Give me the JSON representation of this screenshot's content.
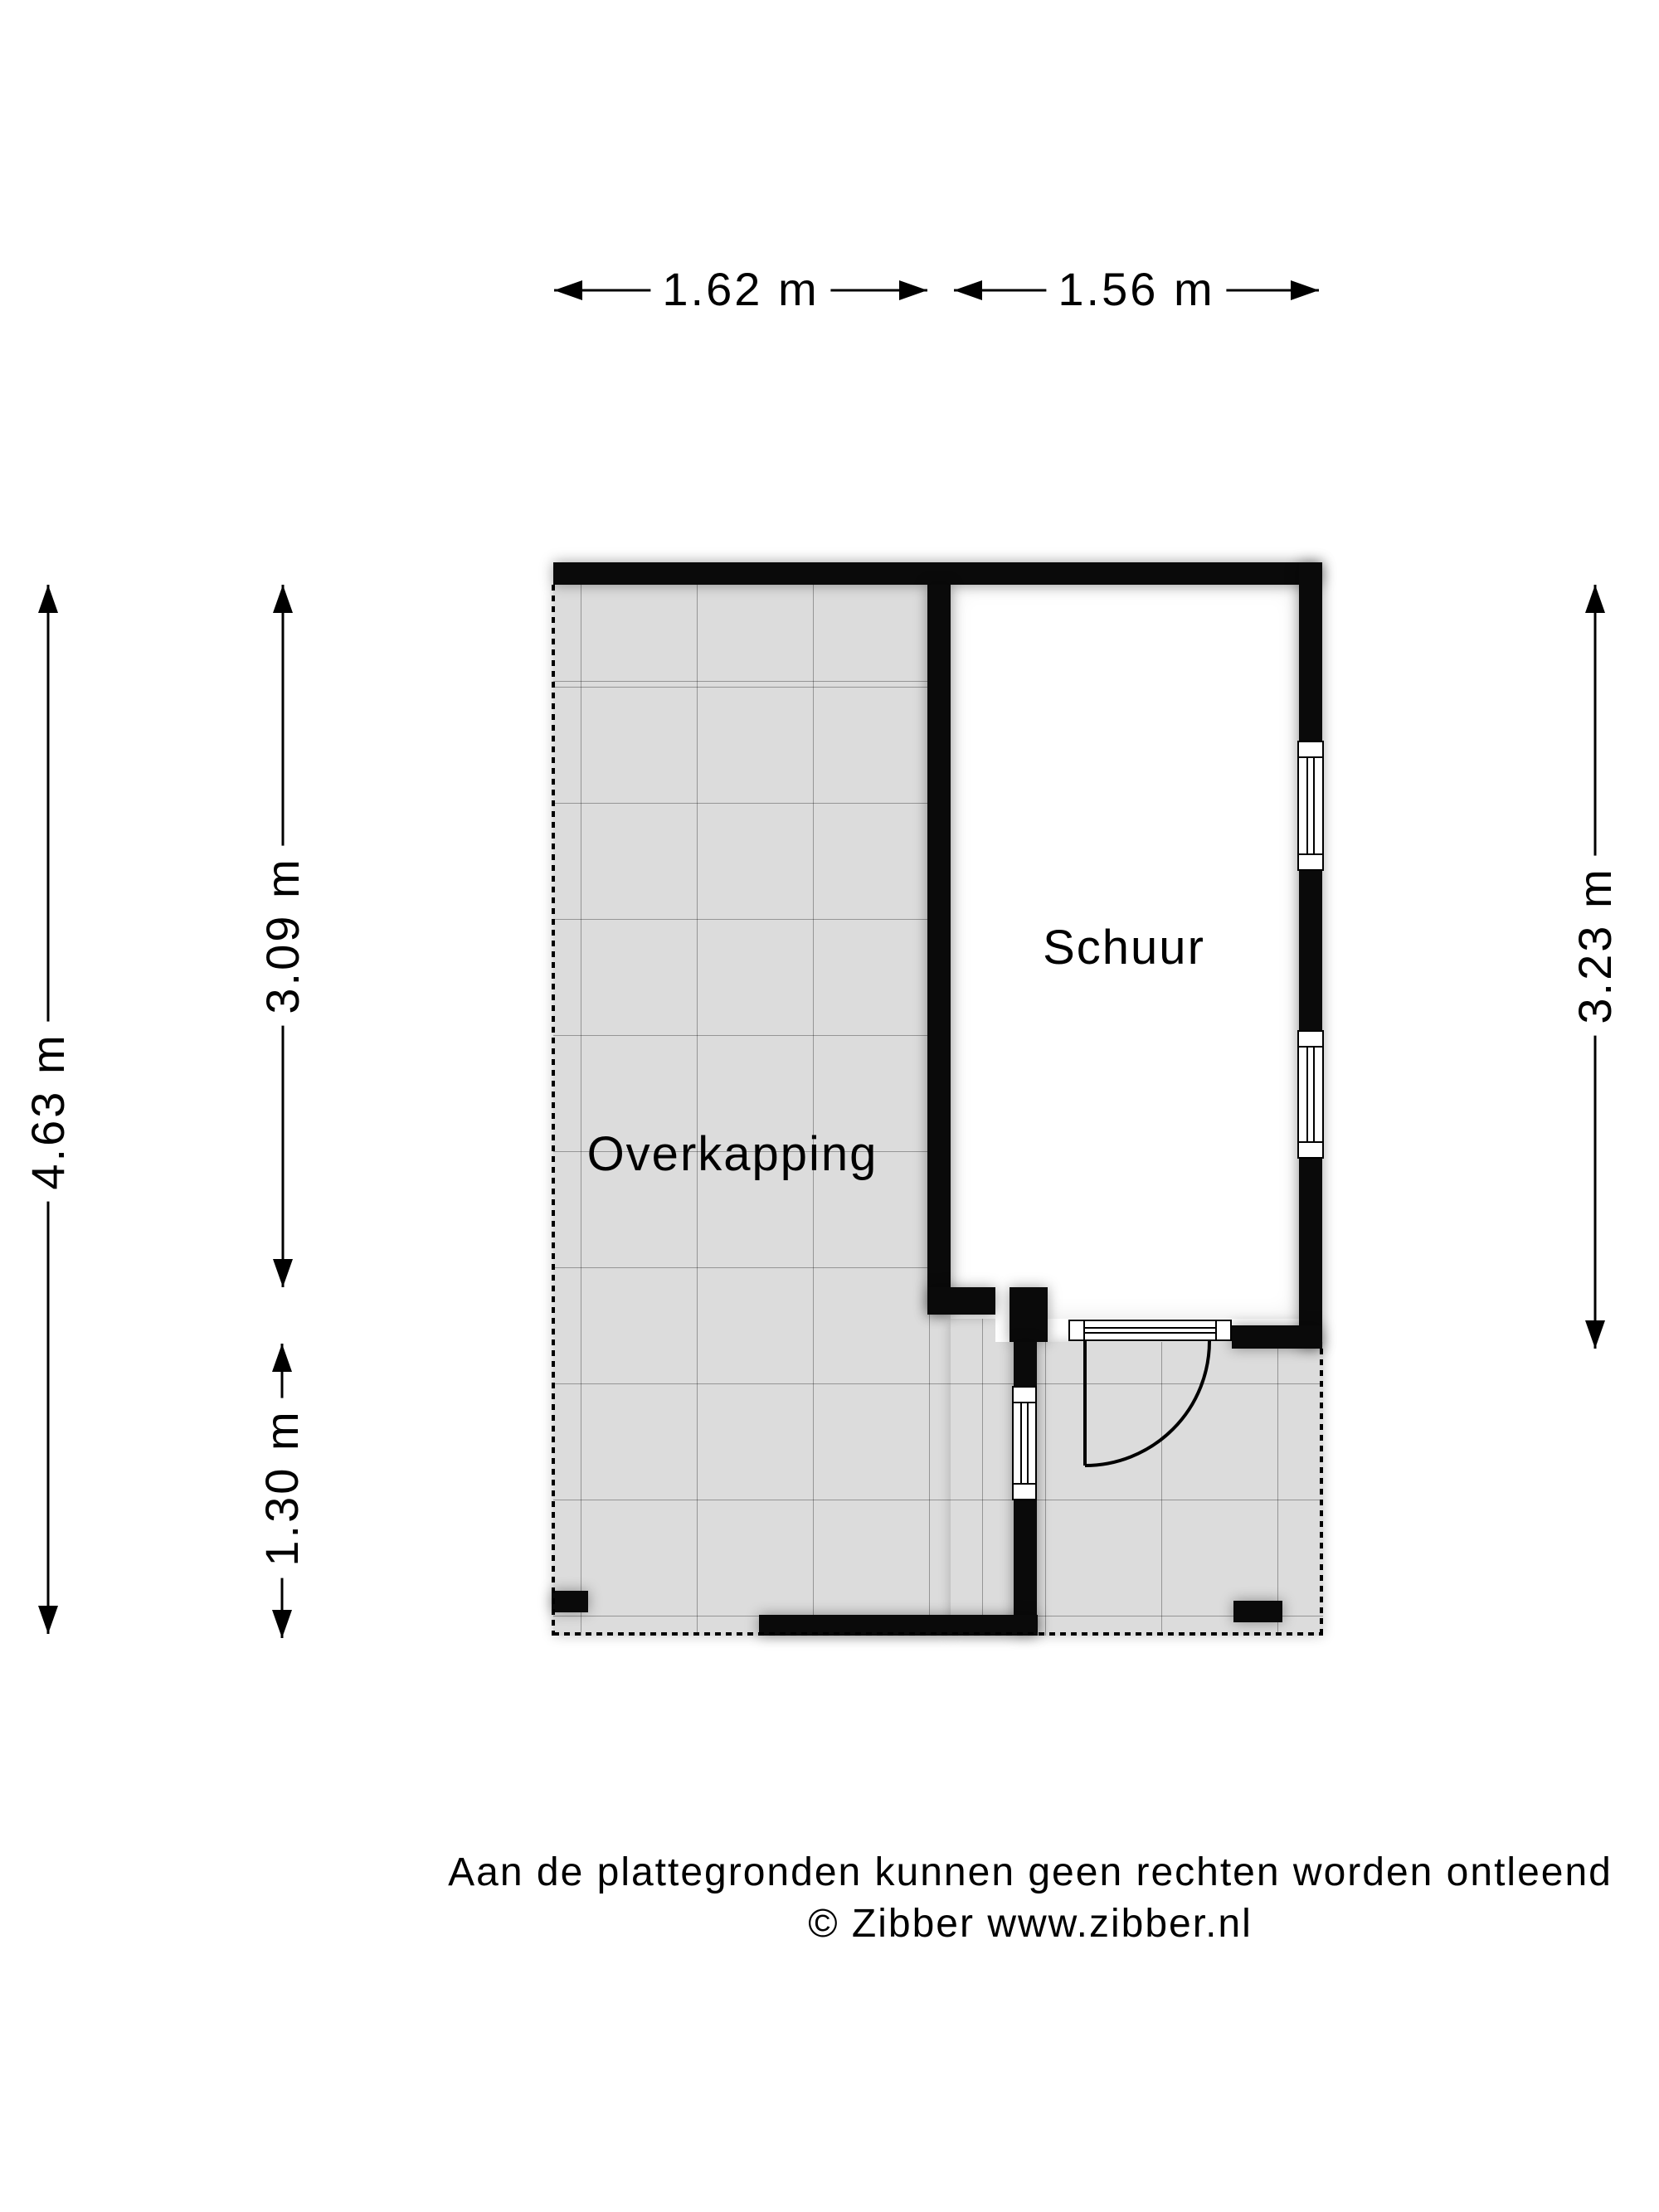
{
  "rooms": [
    {
      "label": "Schuur"
    },
    {
      "label": "Overkapping"
    }
  ],
  "dimensions": {
    "top_left": "1.62 m",
    "top_right": "1.56 m",
    "left_total": "4.63 m",
    "left_upper": "3.09 m",
    "left_lower": "1.30 m",
    "right": "3.23 m"
  },
  "footer": {
    "line1": "Aan de plattegronden kunnen geen rechten worden ontleend",
    "line2": "© Zibber www.zibber.nl"
  },
  "colors": {
    "wall": "#0a0a0a",
    "tile_fill": "#dcdcdc",
    "background": "#ffffff",
    "text": "#000000"
  }
}
